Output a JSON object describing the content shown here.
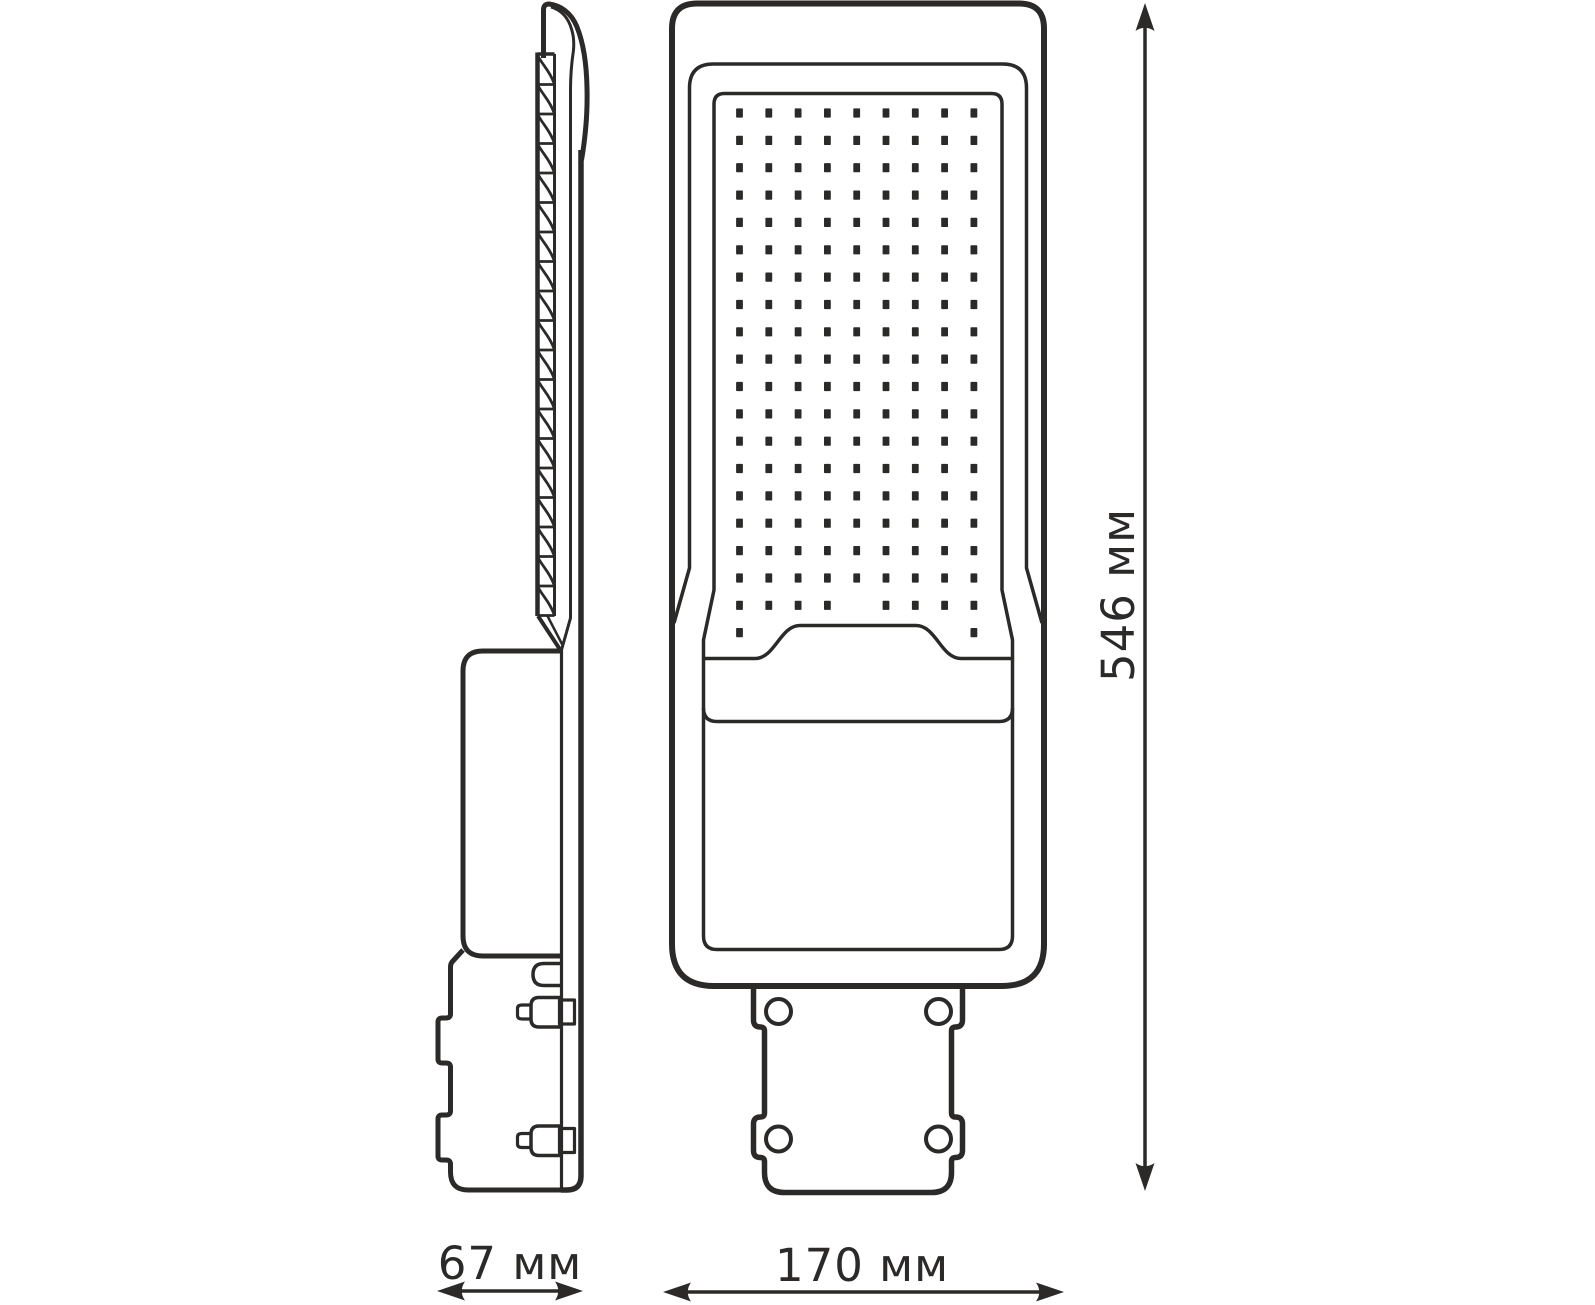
{
  "dimensions": {
    "height_label": "546 мм",
    "side_width_label": "67 мм",
    "front_width_label": "170 мм"
  },
  "colors": {
    "line": "#2b2a29",
    "text": "#2b2a29",
    "background": "#ffffff"
  },
  "drawing": {
    "led_grid": {
      "cols": 9,
      "rows": 20,
      "x0": 739.5,
      "y0": 113,
      "dx": 29.3,
      "dy": 27.35,
      "dot_w": 6.8,
      "dot_h": 9.2,
      "missing": [
        [
          18,
          4
        ],
        [
          19,
          1
        ],
        [
          19,
          2
        ],
        [
          19,
          3
        ],
        [
          19,
          4
        ],
        [
          19,
          5
        ],
        [
          19,
          6
        ],
        [
          19,
          7
        ]
      ]
    },
    "fins": {
      "x1": 537.5,
      "x2": 554.5,
      "top": 55,
      "cell_h": 29.5,
      "count": 19
    }
  }
}
